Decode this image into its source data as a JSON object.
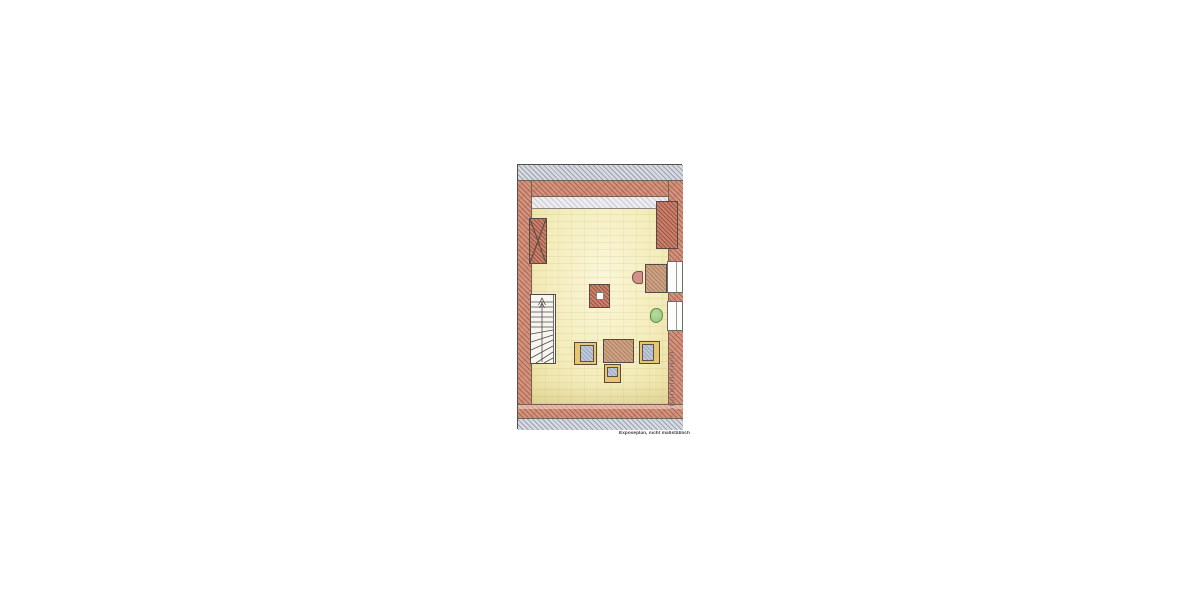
{
  "page": {
    "background_color": "#ffffff"
  },
  "plan": {
    "caption": "Exposéplan, nicht maßstäblich",
    "colors": {
      "wall_fill": "#d0947f",
      "wall_stroke": "#923a28",
      "roof_band_fill": "#d7dae1",
      "attic_strip_fill": "#ededf0",
      "floor_light": "#faf6d8",
      "floor_dark": "#eadfa0",
      "wood_fill": "#cba487",
      "seat_blue": "#c0cada",
      "seat_yellow": "#e7c56d",
      "desk_chair_pink": "#d2938a",
      "plant_green": "#96c47c",
      "outline": "#575049"
    },
    "objects": [
      "roof-band-top",
      "roof-band-bottom",
      "attic-headroom-strip",
      "chimney-with-cross",
      "winder-staircase-up-arrow",
      "free-standing-pillar",
      "coffee-table",
      "armchair-left",
      "armchair-right",
      "side-chair",
      "desk",
      "desk-chair",
      "potted-plant",
      "wall-chimney-block",
      "window-upper",
      "window-lower",
      "vertical-watermark-signature"
    ]
  }
}
